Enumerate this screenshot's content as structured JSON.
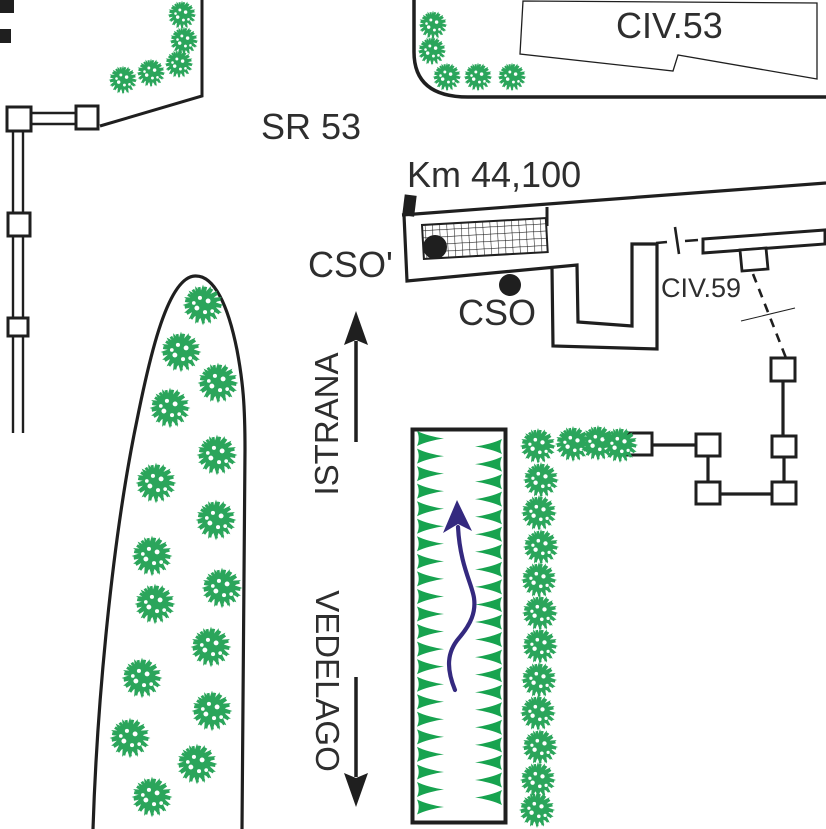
{
  "title": "road location sketch",
  "labels": {
    "road_name": "SR 53",
    "building_top_right": "CIV.53",
    "km_marker": "Km 44,100",
    "cso_prime": "CSO'",
    "cso": "CSO",
    "civ59": "CIV.59",
    "direction_up": "ISTRANA",
    "direction_down": "VEDELAGO"
  },
  "colors": {
    "line": "#1f1f1f",
    "text": "#2e2e2e",
    "vegetation_green": "#2ba55b",
    "hedge_triangle_green": "#17a34f",
    "route_arrow_navy": "#34297f",
    "background": "#ffffff"
  },
  "symbols": {
    "filled_dot_left": "CSO' manhole point",
    "filled_dot_right": "CSO manhole point",
    "hatched_area": "grated sidewalk strip",
    "squares_chain": "fence posts",
    "dashed_line": "property boundary"
  }
}
